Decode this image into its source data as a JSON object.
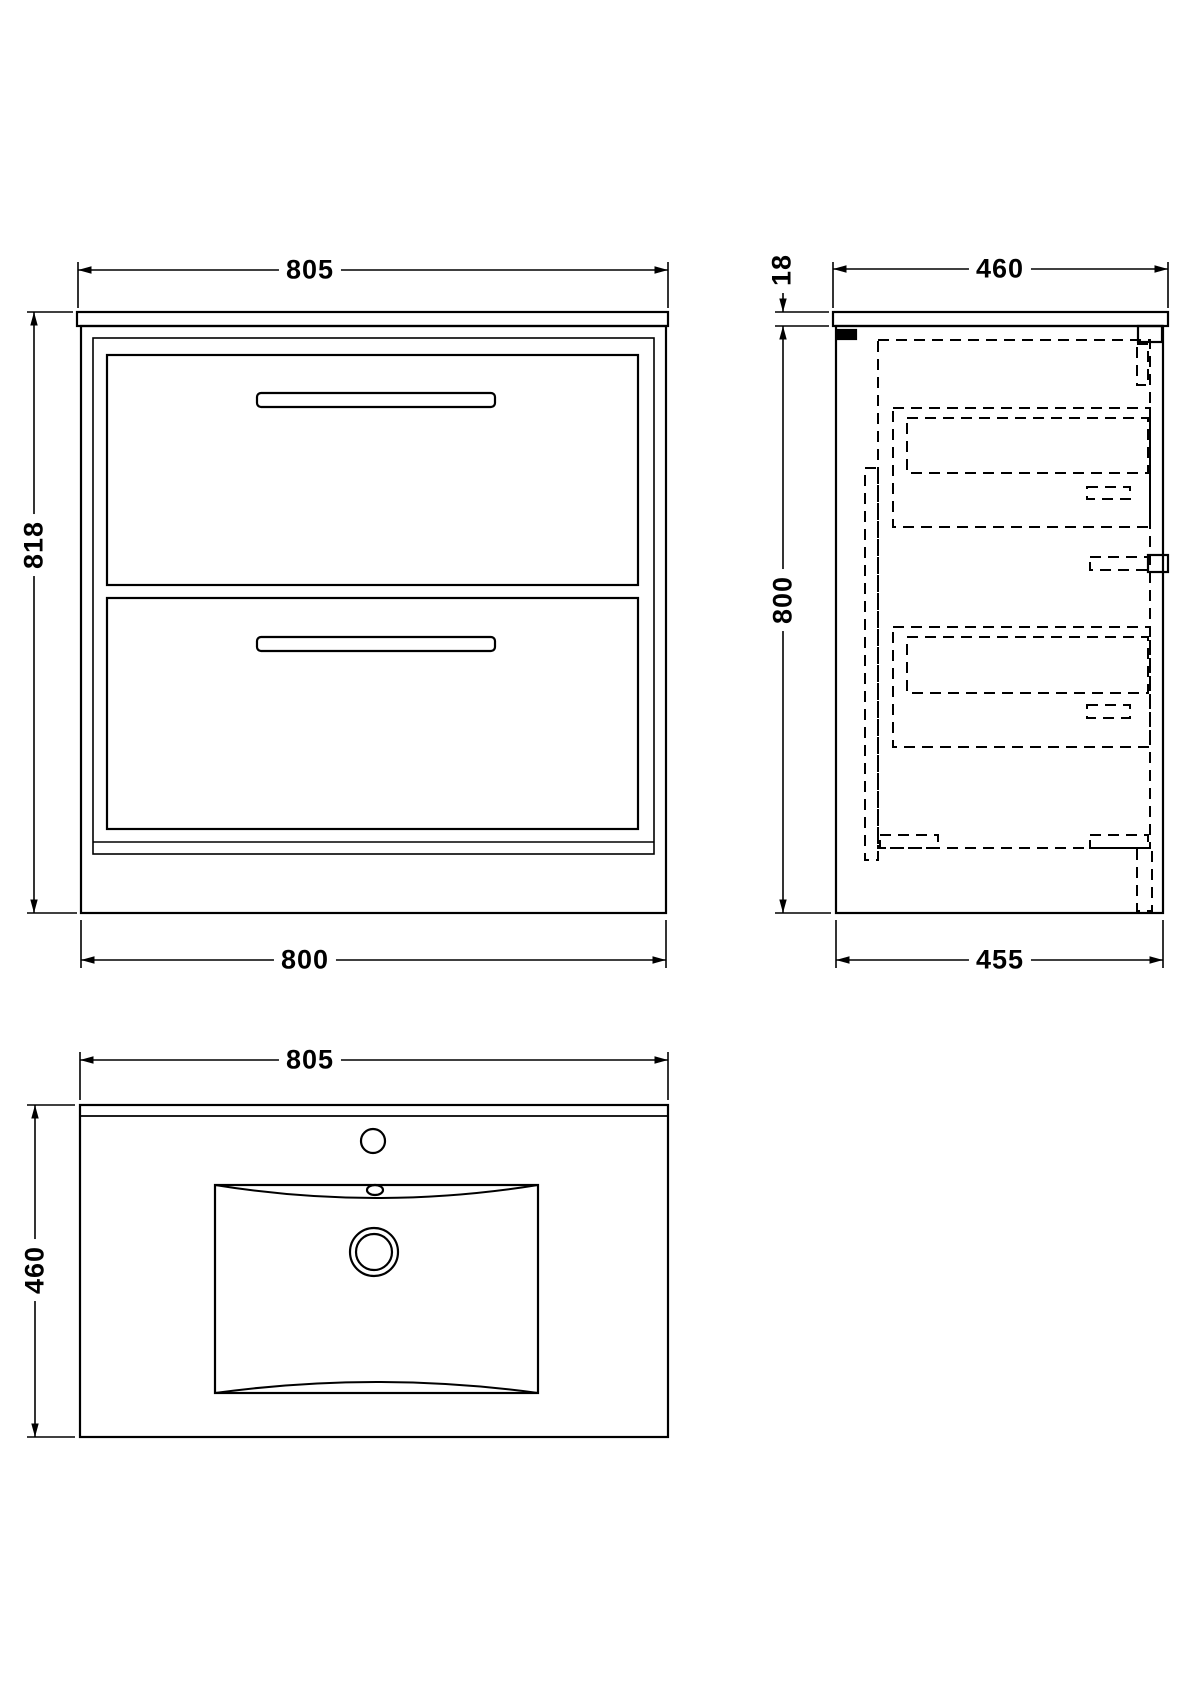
{
  "drawing_type": "bathroom-vanity-unit-technical-drawing",
  "colors": {
    "line": "#000000",
    "background": "#ffffff"
  },
  "views": {
    "front": {
      "top_width": "805",
      "height": "818",
      "bottom_width": "800"
    },
    "side": {
      "top_depth": "460",
      "counter_thickness": "18",
      "body_height": "800",
      "bottom_depth": "455"
    },
    "basin": {
      "width": "805",
      "depth": "460"
    }
  }
}
